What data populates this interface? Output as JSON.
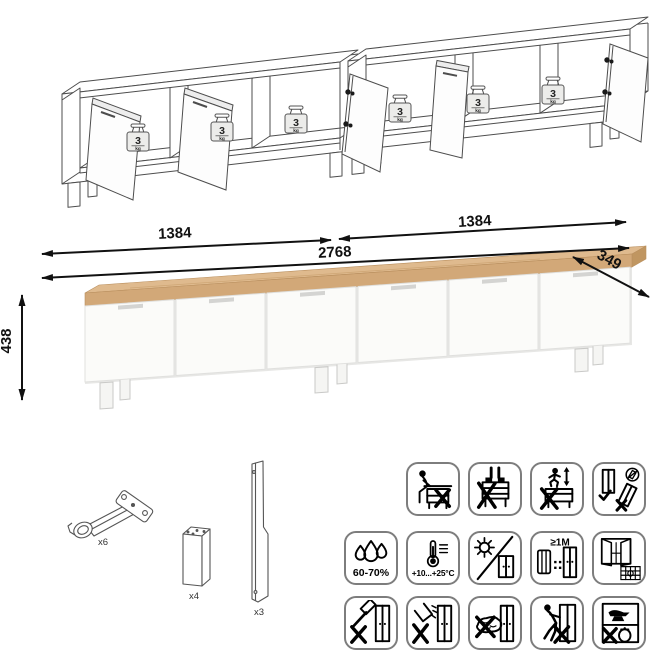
{
  "assembled_view": {
    "description": "two TV-stand sections with open doors",
    "weight": {
      "value": "3",
      "unit": "kg"
    }
  },
  "dimensions": {
    "left_section_width": "1384",
    "right_section_width": "1384",
    "total_width": "2768",
    "depth": "349",
    "height": "438"
  },
  "hardware": {
    "items": [
      {
        "name": "concealed-hinge",
        "count": "x6"
      },
      {
        "name": "square-leg",
        "count": "x4"
      },
      {
        "name": "back-rail-panel",
        "count": "x3"
      }
    ]
  },
  "safety_icons": {
    "row1": [
      {
        "name": "no-sitting"
      },
      {
        "name": "no-standing"
      },
      {
        "name": "no-jumping"
      },
      {
        "name": "assemble-upright-only"
      }
    ],
    "row2": [
      {
        "name": "humidity-range",
        "label": "60-70%"
      },
      {
        "name": "temperature-range",
        "label": "+10...+25°C"
      },
      {
        "name": "no-direct-sunlight"
      },
      {
        "name": "keep-1m-from-heat",
        "label": "≥1M"
      },
      {
        "name": "ventilate-room"
      }
    ],
    "row3": [
      {
        "name": "no-hammering"
      },
      {
        "name": "no-liquids"
      },
      {
        "name": "no-abrasives"
      },
      {
        "name": "no-dragging"
      },
      {
        "name": "no-heavy-objects"
      }
    ]
  },
  "colors": {
    "wood_top": "#d2a878",
    "wood_top_light": "#dfba8e",
    "wood_top_dark": "#c09661",
    "door_front": "#fbfbf9",
    "outline": "#4d4d4d",
    "icon_border": "#7d7d7d"
  }
}
